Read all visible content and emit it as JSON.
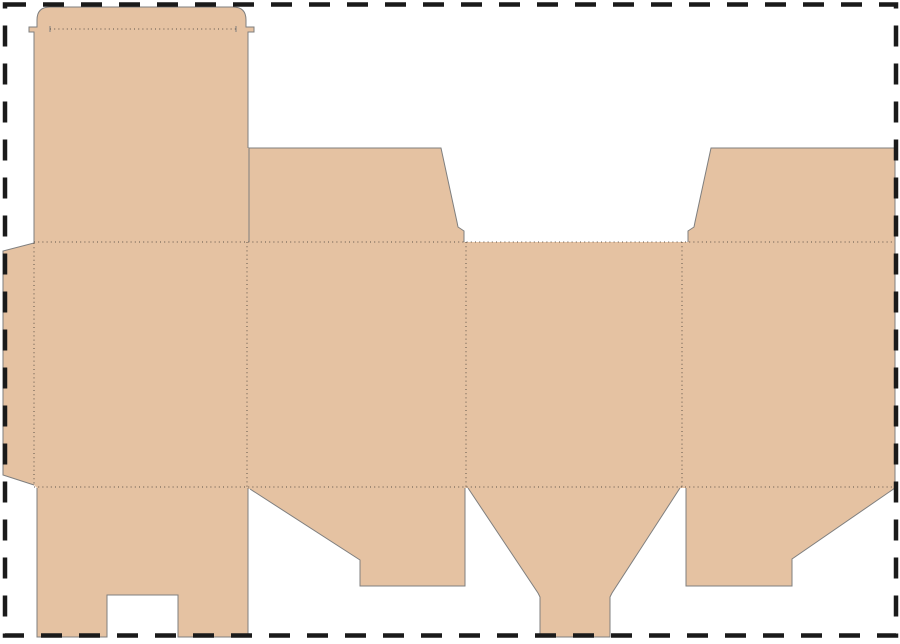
{
  "canvas": {
    "width": 900,
    "height": 644,
    "background": "#ffffff"
  },
  "page_border": {
    "color": "#1a1a1a",
    "stroke_width": 4.5,
    "dash_pattern": "21 17",
    "x": 5,
    "y": 4.5,
    "width": 891,
    "height": 631
  },
  "dieline": {
    "board_fill": "#e5c2a2",
    "cut_color": "#7f7f7f",
    "cut_stroke_width": 1,
    "fold_color": "#5c5248",
    "fold_dash": "1 3.2",
    "fold_stroke_width": 1,
    "silhouette_path": "M 37 20 Q 37 7 50 7 L 233 7 Q 246 7 246 20 L 246 27 L 254 27 L 254 32 L 248 32 L 248 148 L 441 148 L 457 222 L 458 227 L 464 231 L 464 242 L 688 242 L 688 231 L 694 227 L 695 222 L 711 148 L 895 148 L 895 488 L 792 559 L 792 586 L 686 586 L 686 488 L 680 488 L 612 593 L 610 597 L 610 637 L 540 637 L 540 597 L 538 593 L 468 488 L 465 488 L 465 586 L 360 586 L 360 560 L 250 489 L 248 489 L 248 637 L 178 637 L 178 595 L 107 595 L 107 637 L 37 637 L 37 488 L 34 485 L 3 475 L 3 251 L 34 243 L 34 32 L 29 32 L 29 27 L 37 27 Z",
    "cut_tuck_left_and_glue_tab": "M 248 148 L 248 32 L 254 32 L 254 27 L 246 27 L 246 20 Q 246 7 233 7 L 50 7 Q 37 7 37 20 L 37 27 L 29 27 L 29 32 L 34 32 L 34 243 L 3 251 L 3 475 L 34 485",
    "cut_top_flap_left": "M 249 242 L 249 148 L 441 148 L 457 222 L 458 227 L 464 231 L 464 242",
    "cut_top_flap_right_and_side": "M 688 242 L 688 231 L 694 227 L 695 222 L 711 148 L 895 148 L 895 488 L 792 559 L 792 586 L 686 586 L 686 488",
    "cut_bottom_flap_funnel": "M 680 488 L 612 593 L 610 597 L 610 637 L 540 637 L 540 597 L 538 593 L 468 488",
    "cut_bottom_flap_2": "M 465 488 L 465 586 L 360 586 L 360 560 L 250 489",
    "cut_bottom_flap_1_notched": "M 248 488 L 248 637 L 178 637 L 178 595 L 107 595 L 107 637 L 37 637 L 37 488",
    "cut_crease_ticks": "M 50 26 L 50 32 M 236 26 L 236 32",
    "fold_lines_path": "M 50 29 L 236 29 M 34 242 L 895 242 M 34 487 L 895 487 M 34 243 L 34 484 M 247 242 L 247 487 M 466 242 L 466 487 M 682 242 L 682 487"
  }
}
